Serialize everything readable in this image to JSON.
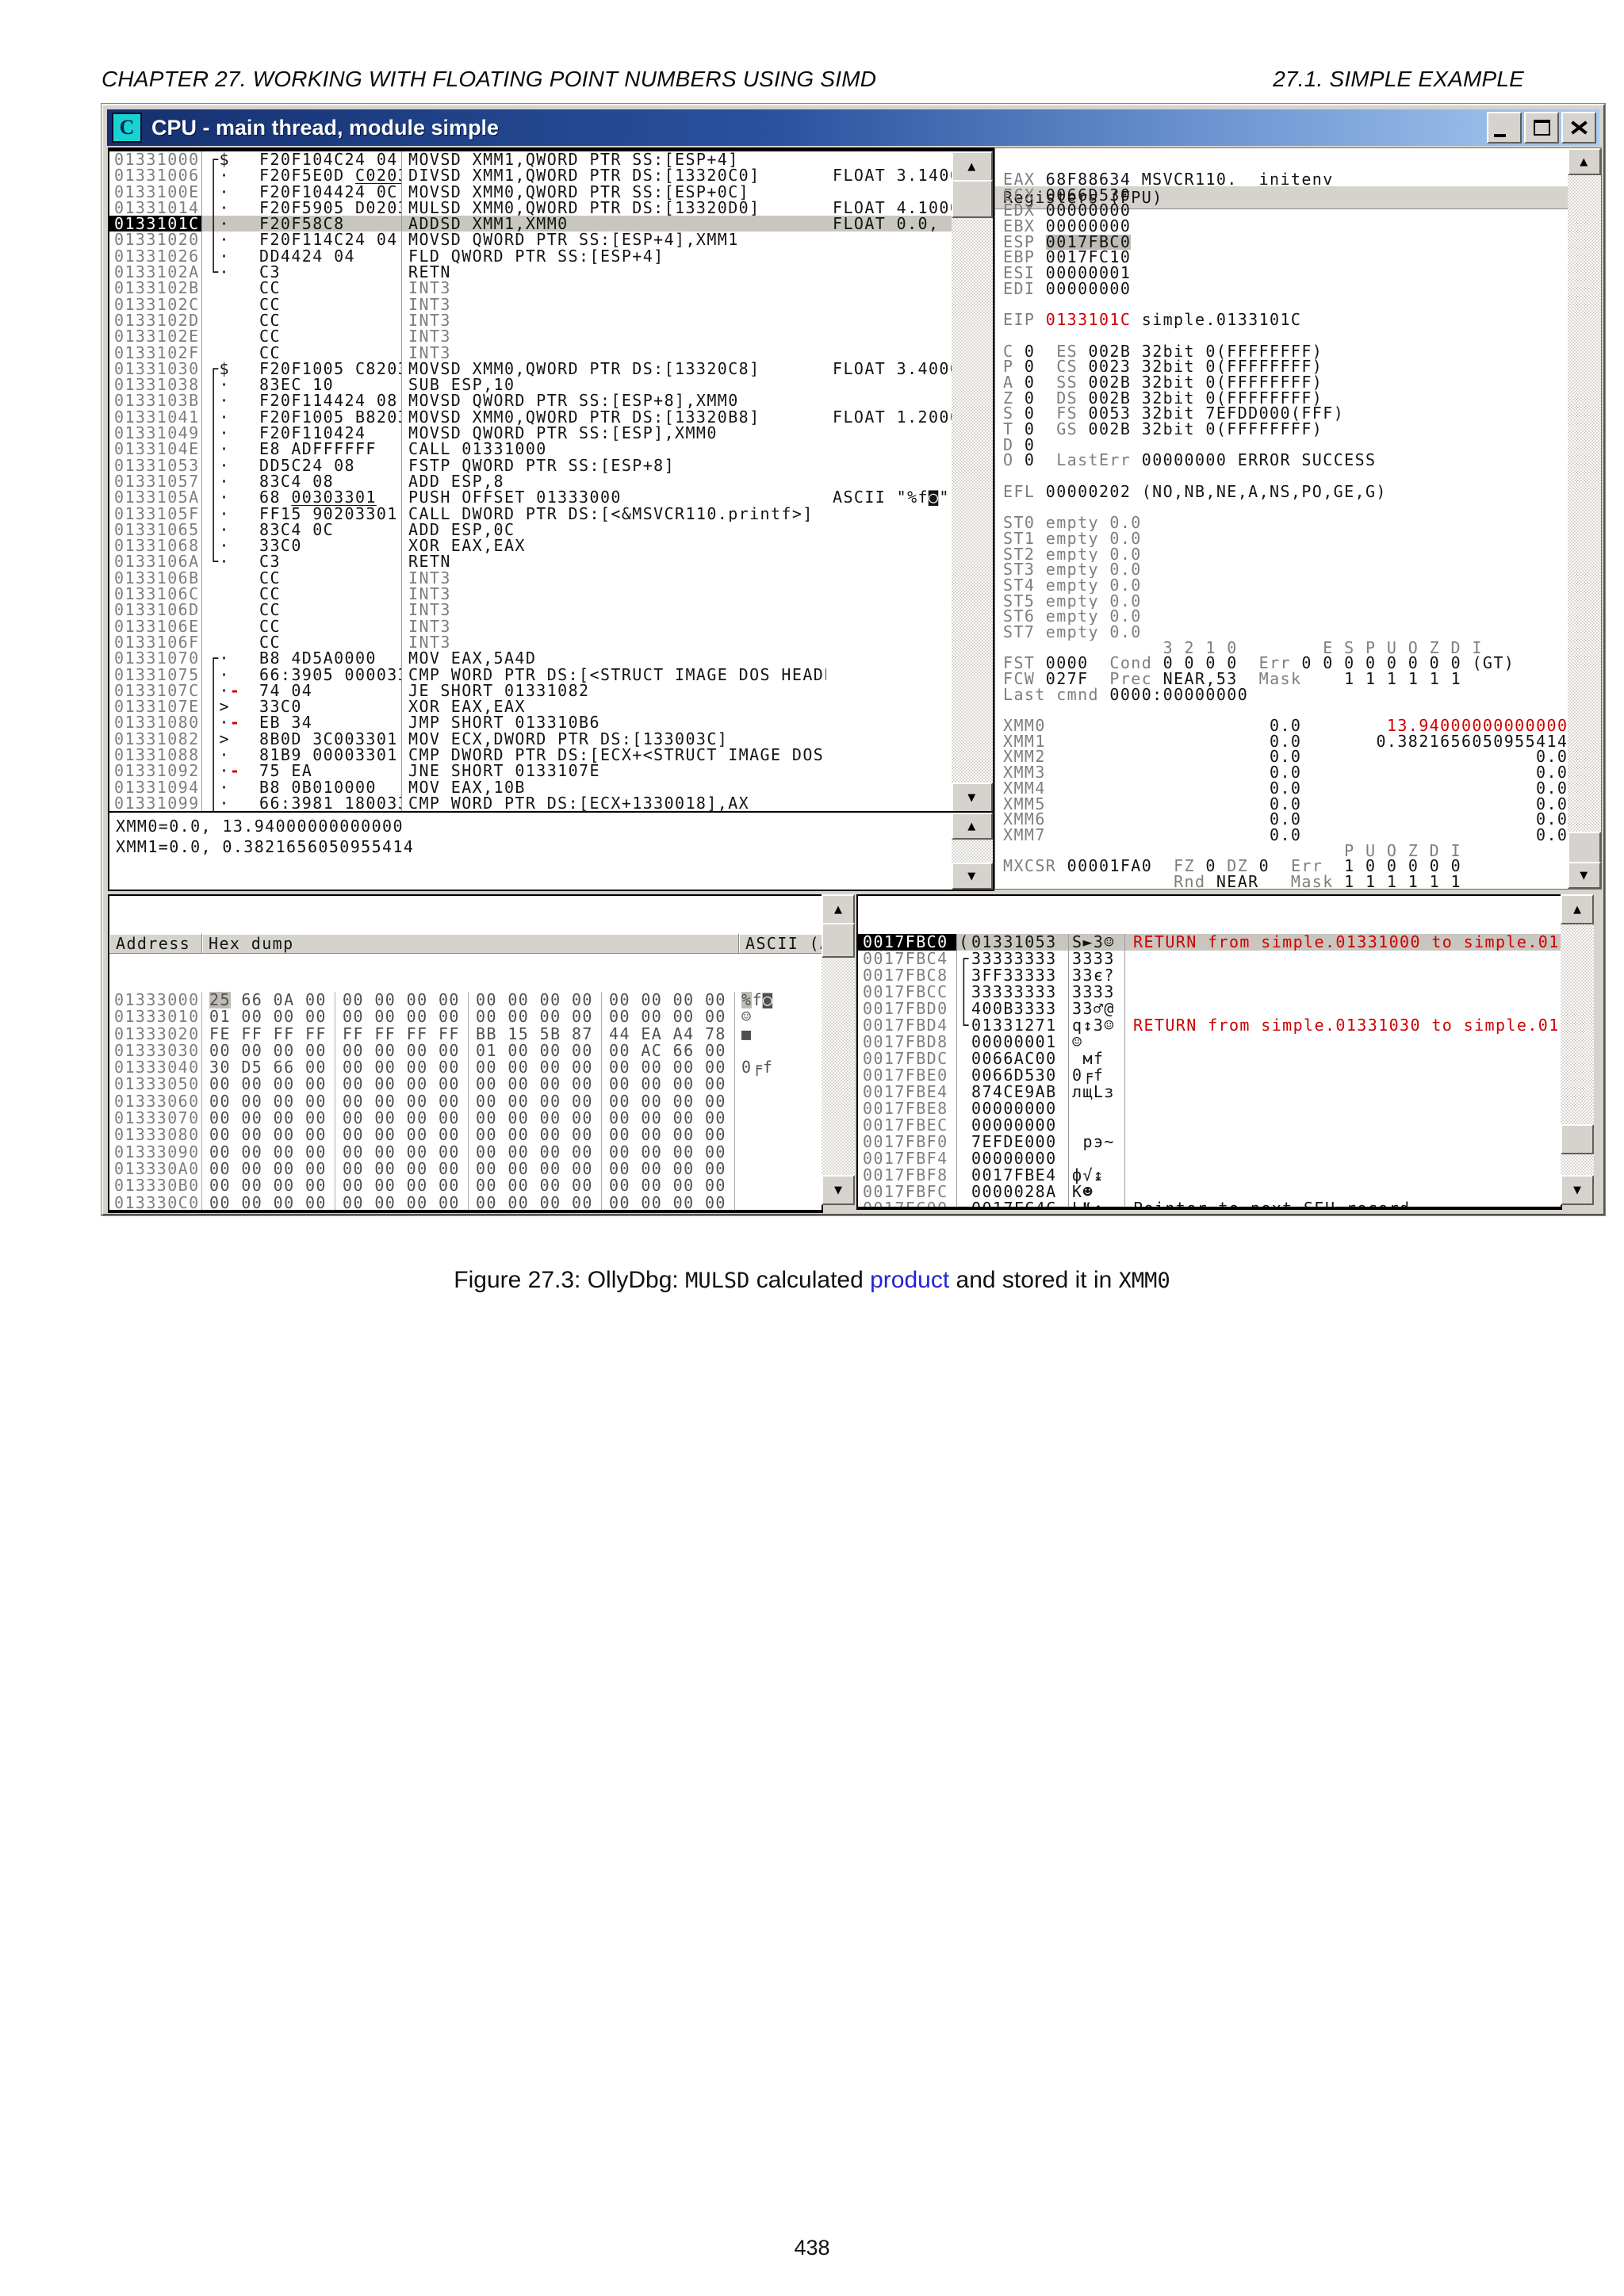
{
  "page": {
    "header_left": "CHAPTER 27.  WORKING WITH FLOATING POINT NUMBERS USING SIMD",
    "header_right": "27.1.  SIMPLE EXAMPLE",
    "page_number": "438",
    "caption": {
      "p1": "Figure 27.3: OllyDbg: ",
      "m1": "MULSD",
      "p2": " calculated ",
      "link": "product",
      "p3": " and stored it in ",
      "m2": "XMM0"
    }
  },
  "window": {
    "title": "CPU - main thread, module simple",
    "icon_letter": "C"
  },
  "colors": {
    "accent_red": "#CE0000",
    "link_blue": "#2323d8",
    "title_gradient_left": "#15306F",
    "title_gradient_right": "#A9CBF2",
    "selection_gray": "#C9C6BF"
  },
  "disasm": {
    "rows": [
      {
        "a": "01331000",
        "br": "┌",
        "m": "$",
        "b": "F20F104C24 04",
        "i": "MOVSD XMM1,QWORD PTR SS:[ESP+4]"
      },
      {
        "a": "01331006",
        "br": "│",
        "m": "·",
        "b": "F20F5E0D ",
        "u": "C0203301",
        "i": "DIVSD XMM1,QWORD PTR DS:[13320C0]",
        "c": "FLOAT 3.140000000000000"
      },
      {
        "a": "0133100E",
        "br": "│",
        "m": "·",
        "b": "F20F104424 0C",
        "i": "MOVSD XMM0,QWORD PTR SS:[ESP+0C]"
      },
      {
        "a": "01331014",
        "br": "│",
        "m": "·",
        "b": "F20F5905 ",
        "u": "D0203301",
        "i": "MULSD XMM0,QWORD PTR DS:[13320D0]",
        "c": "FLOAT 4.100000000000000"
      },
      {
        "a": "0133101C",
        "sel": true,
        "br": "│",
        "m": "·",
        "b": "F20F58C8",
        "i": "ADDSD XMM1,XMM0",
        "c": "FLOAT 0.0, 13.94000000000000"
      },
      {
        "a": "01331020",
        "br": "│",
        "m": "·",
        "b": "F20F114C24 04",
        "i": "MOVSD QWORD PTR SS:[ESP+4],XMM1"
      },
      {
        "a": "01331026",
        "br": "│",
        "m": "·",
        "b": "DD4424 04",
        "i": "FLD QWORD PTR SS:[ESP+4]"
      },
      {
        "a": "0133102A",
        "br": "└",
        "m": "·",
        "b": "C3",
        "i": "RETN"
      },
      {
        "a": "0133102B",
        "b": "CC",
        "i": "INT3",
        "gray": true
      },
      {
        "a": "0133102C",
        "b": "CC",
        "i": "INT3",
        "gray": true
      },
      {
        "a": "0133102D",
        "b": "CC",
        "i": "INT3",
        "gray": true
      },
      {
        "a": "0133102E",
        "b": "CC",
        "i": "INT3",
        "gray": true
      },
      {
        "a": "0133102F",
        "b": "CC",
        "i": "INT3",
        "gray": true
      },
      {
        "a": "01331030",
        "br": "┌",
        "m": "$",
        "b": "F20F1005 ",
        "u": "C8203301",
        "i": "MOVSD XMM0,QWORD PTR DS:[13320C8]",
        "c": "FLOAT 3.400000000000000"
      },
      {
        "a": "01331038",
        "br": "│",
        "m": "·",
        "b": "83EC 10",
        "i": "SUB ESP,10"
      },
      {
        "a": "0133103B",
        "br": "│",
        "m": "·",
        "b": "F20F114424 08",
        "i": "MOVSD QWORD PTR SS:[ESP+8],XMM0"
      },
      {
        "a": "01331041",
        "br": "│",
        "m": "·",
        "b": "F20F1005 ",
        "u": "B8203301",
        "i": "MOVSD XMM0,QWORD PTR DS:[13320B8]",
        "c": "FLOAT 1.200000000000000"
      },
      {
        "a": "01331049",
        "br": "│",
        "m": "·",
        "b": "F20F110424",
        "i": "MOVSD QWORD PTR SS:[ESP],XMM0"
      },
      {
        "a": "0133104E",
        "br": "│",
        "m": "·",
        "b": "E8 ADFFFFFF",
        "i": "CALL 01331000"
      },
      {
        "a": "01331053",
        "br": "│",
        "m": "·",
        "b": "DD5C24 08",
        "i": "FSTP QWORD PTR SS:[ESP+8]"
      },
      {
        "a": "01331057",
        "br": "│",
        "m": "·",
        "b": "83C4 08",
        "i": "ADD ESP,8"
      },
      {
        "a": "0133105A",
        "br": "│",
        "m": "·",
        "b": "68 ",
        "u": "00303301",
        "i": "PUSH OFFSET 01333000",
        "c": "ASCII \"%f◙\""
      },
      {
        "a": "0133105F",
        "br": "│",
        "m": "·",
        "b": "FF15 ",
        "u": "90203301",
        "i": "CALL DWORD PTR DS:[<&MSVCR110.printf>]"
      },
      {
        "a": "01331065",
        "br": "│",
        "m": "·",
        "b": "83C4 0C",
        "i": "ADD ESP,0C"
      },
      {
        "a": "01331068",
        "br": "│",
        "m": "·",
        "b": "33C0",
        "i": "XOR EAX,EAX"
      },
      {
        "a": "0133106A",
        "br": "└",
        "m": "·",
        "b": "C3",
        "i": "RETN"
      },
      {
        "a": "0133106B",
        "b": "CC",
        "i": "INT3",
        "gray": true
      },
      {
        "a": "0133106C",
        "b": "CC",
        "i": "INT3",
        "gray": true
      },
      {
        "a": "0133106D",
        "b": "CC",
        "i": "INT3",
        "gray": true
      },
      {
        "a": "0133106E",
        "b": "CC",
        "i": "INT3",
        "gray": true
      },
      {
        "a": "0133106F",
        "b": "CC",
        "i": "INT3",
        "gray": true
      },
      {
        "a": "01331070",
        "br": "┌",
        "m": "·",
        "b": "B8 4D5A0000",
        "i": "MOV EAX,5A4D"
      },
      {
        "a": "01331075",
        "br": "│",
        "m": "·",
        "b": "66:3905 ",
        "u": "00003301",
        "i": "CMP WORD PTR DS:[<STRUCT IMAGE_DOS_HEADER"
      },
      {
        "a": "0133107C",
        "br": "│",
        "m": "·",
        "dash": true,
        "b": "74 04",
        "i": "JE SHORT 01331082"
      },
      {
        "a": "0133107E",
        "br": "│",
        "m": ">",
        "b": "33C0",
        "i": "XOR EAX,EAX"
      },
      {
        "a": "01331080",
        "br": "│",
        "m": "·",
        "dash": true,
        "b": "EB 34",
        "i": "JMP SHORT 013310B6"
      },
      {
        "a": "01331082",
        "br": "│",
        "m": ">",
        "b": "8B0D ",
        "u": "3C003301",
        "i": "MOV ECX,DWORD PTR DS:[133003C]"
      },
      {
        "a": "01331088",
        "br": "│",
        "m": "·",
        "b": "81B9 ",
        "u": "00003301",
        "i": "CMP DWORD PTR DS:[ECX+<STRUCT IMAGE_DOS_H"
      },
      {
        "a": "01331092",
        "br": "│",
        "m": "·",
        "dash": true,
        "b": "75 EA",
        "i": "JNE SHORT 0133107E"
      },
      {
        "a": "01331094",
        "br": "│",
        "m": "·",
        "b": "B8 0B010000",
        "i": "MOV EAX,10B"
      },
      {
        "a": "01331099",
        "br": "│",
        "m": "·",
        "b": "66:3981 ",
        "u": "18003301",
        "i": "CMP WORD PTR DS:[ECX+1330018],AX"
      }
    ]
  },
  "info_pane": {
    "lines": [
      "XMM0=0.0, 13.94000000000000",
      "XMM1=0.0, 0.3821656050955414"
    ]
  },
  "registers": {
    "title": "Registers (FPU)",
    "lines": [
      [
        [
          "EAX ",
          "n"
        ],
        [
          "68F88634 MSVCR110.__initenv",
          ""
        ]
      ],
      [
        [
          "ECX ",
          "n"
        ],
        [
          "0066D530",
          ""
        ]
      ],
      [
        [
          "EDX ",
          "n"
        ],
        [
          "00000000",
          ""
        ]
      ],
      [
        [
          "EBX ",
          "n"
        ],
        [
          "00000000",
          ""
        ]
      ],
      [
        [
          "ESP ",
          "n"
        ],
        [
          "0017FBC0",
          "h"
        ]
      ],
      [
        [
          "EBP ",
          "n"
        ],
        [
          "0017FC10",
          ""
        ]
      ],
      [
        [
          "ESI ",
          "n"
        ],
        [
          "00000001",
          ""
        ]
      ],
      [
        [
          "EDI ",
          "n"
        ],
        [
          "00000000",
          ""
        ]
      ],
      [],
      [
        [
          "EIP ",
          "n"
        ],
        [
          "0133101C",
          "r"
        ],
        [
          " simple.0133101C",
          ""
        ]
      ],
      [],
      [
        [
          "C ",
          "n"
        ],
        [
          "0  ",
          ""
        ],
        [
          "ES ",
          "n"
        ],
        [
          "002B 32bit 0(FFFFFFFF)",
          ""
        ]
      ],
      [
        [
          "P ",
          "n"
        ],
        [
          "0  ",
          ""
        ],
        [
          "CS ",
          "n"
        ],
        [
          "0023 32bit 0(FFFFFFFF)",
          ""
        ]
      ],
      [
        [
          "A ",
          "n"
        ],
        [
          "0  ",
          ""
        ],
        [
          "SS ",
          "n"
        ],
        [
          "002B 32bit 0(FFFFFFFF)",
          ""
        ]
      ],
      [
        [
          "Z ",
          "n"
        ],
        [
          "0  ",
          ""
        ],
        [
          "DS ",
          "n"
        ],
        [
          "002B 32bit 0(FFFFFFFF)",
          ""
        ]
      ],
      [
        [
          "S ",
          "n"
        ],
        [
          "0  ",
          ""
        ],
        [
          "FS ",
          "n"
        ],
        [
          "0053 32bit 7EFDD000(FFF)",
          ""
        ]
      ],
      [
        [
          "T ",
          "n"
        ],
        [
          "0  ",
          ""
        ],
        [
          "GS ",
          "n"
        ],
        [
          "002B 32bit 0(FFFFFFFF)",
          ""
        ]
      ],
      [
        [
          "D ",
          "n"
        ],
        [
          "0",
          ""
        ]
      ],
      [
        [
          "O ",
          "n"
        ],
        [
          "0  ",
          ""
        ],
        [
          "LastErr ",
          "n"
        ],
        [
          "00000000 ERROR_SUCCESS",
          ""
        ]
      ],
      [],
      [
        [
          "EFL ",
          "n"
        ],
        [
          "00000202 (NO,NB,NE,A,NS,PO,GE,G)",
          ""
        ]
      ],
      [],
      [
        [
          "ST0 empty 0.0",
          "n"
        ]
      ],
      [
        [
          "ST1 empty 0.0",
          "n"
        ]
      ],
      [
        [
          "ST2 empty 0.0",
          "n"
        ]
      ],
      [
        [
          "ST3 empty 0.0",
          "n"
        ]
      ],
      [
        [
          "ST4 empty 0.0",
          "n"
        ]
      ],
      [
        [
          "ST5 empty 0.0",
          "n"
        ]
      ],
      [
        [
          "ST6 empty 0.0",
          "n"
        ]
      ],
      [
        [
          "ST7 empty 0.0",
          "n"
        ]
      ],
      [
        [
          "               3 2 1 0        E S P U O Z D I",
          "n"
        ]
      ],
      [
        [
          "FST ",
          "n"
        ],
        [
          "0000  ",
          ""
        ],
        [
          "Cond ",
          "n"
        ],
        [
          "0 0 0 0  ",
          ""
        ],
        [
          "Err ",
          "n"
        ],
        [
          "0 0 0 0 0 0 0 0 (GT)",
          ""
        ]
      ],
      [
        [
          "FCW ",
          "n"
        ],
        [
          "027F  ",
          ""
        ],
        [
          "Prec ",
          "n"
        ],
        [
          "NEAR,53  ",
          ""
        ],
        [
          "Mask ",
          "n"
        ],
        [
          "   1 1 1 1 1 1",
          ""
        ]
      ],
      [
        [
          "Last cmnd ",
          "n"
        ],
        [
          "0000:00000000",
          ""
        ]
      ],
      [],
      [
        [
          "XMM0",
          "n"
        ],
        [
          "                     0.0        ",
          ""
        ],
        [
          "13.94000000000000",
          "r"
        ]
      ],
      [
        [
          "XMM1",
          "n"
        ],
        [
          "                     0.0       ",
          ""
        ],
        [
          "0.3821656050955414",
          ""
        ]
      ],
      [
        [
          "XMM2",
          "n"
        ],
        [
          "                     0.0                      0.0",
          ""
        ]
      ],
      [
        [
          "XMM3",
          "n"
        ],
        [
          "                     0.0                      0.0",
          ""
        ]
      ],
      [
        [
          "XMM4",
          "n"
        ],
        [
          "                     0.0                      0.0",
          ""
        ]
      ],
      [
        [
          "XMM5",
          "n"
        ],
        [
          "                     0.0                      0.0",
          ""
        ]
      ],
      [
        [
          "XMM6",
          "n"
        ],
        [
          "                     0.0                      0.0",
          ""
        ]
      ],
      [
        [
          "XMM7",
          "n"
        ],
        [
          "                     0.0                      0.0",
          ""
        ]
      ],
      [
        [
          "                                P U O Z D I",
          "n"
        ]
      ],
      [
        [
          "MXCSR ",
          "n"
        ],
        [
          "00001FA0  ",
          ""
        ],
        [
          "FZ ",
          "n"
        ],
        [
          "0 ",
          ""
        ],
        [
          "DZ ",
          "n"
        ],
        [
          "0  ",
          ""
        ],
        [
          "Err  ",
          "n"
        ],
        [
          "1 0 0 0 0 0",
          ""
        ]
      ],
      [
        [
          "                ",
          "n"
        ],
        [
          "Rnd ",
          "n"
        ],
        [
          "NEAR   ",
          ""
        ],
        [
          "Mask ",
          "n"
        ],
        [
          "1 1 1 1 1 1",
          ""
        ]
      ]
    ]
  },
  "dump": {
    "headers": {
      "address": "Address",
      "hex": "Hex dump",
      "ascii": "ASCII (ANSI"
    },
    "rows": [
      {
        "a": "01333000",
        "g": [
          "25 66 0A 00",
          "00 00 00 00",
          "00 00 00 00",
          "00 00 00 00"
        ],
        "asc": "%f◙",
        "sel": true
      },
      {
        "a": "01333010",
        "g": [
          "01 00 00 00",
          "00 00 00 00",
          "00 00 00 00",
          "00 00 00 00"
        ],
        "asc": "☺"
      },
      {
        "a": "01333020",
        "g": [
          "FE FF FF FF",
          "FF FF FF FF",
          "BB 15 5B 87",
          "44 EA A4 78"
        ],
        "asc": "■       ╗§[зDъдx"
      },
      {
        "a": "01333030",
        "g": [
          "00 00 00 00",
          "00 00 00 00",
          "01 00 00 00",
          "00 AC 66 00"
        ],
        "asc": ""
      },
      {
        "a": "01333040",
        "g": [
          "30 D5 66 00",
          "00 00 00 00",
          "00 00 00 00",
          "00 00 00 00"
        ],
        "asc": "0╒f"
      },
      {
        "a": "01333050",
        "g": [
          "00 00 00 00",
          "00 00 00 00",
          "00 00 00 00",
          "00 00 00 00"
        ],
        "asc": ""
      },
      {
        "a": "01333060",
        "g": [
          "00 00 00 00",
          "00 00 00 00",
          "00 00 00 00",
          "00 00 00 00"
        ],
        "asc": ""
      },
      {
        "a": "01333070",
        "g": [
          "00 00 00 00",
          "00 00 00 00",
          "00 00 00 00",
          "00 00 00 00"
        ],
        "asc": ""
      },
      {
        "a": "01333080",
        "g": [
          "00 00 00 00",
          "00 00 00 00",
          "00 00 00 00",
          "00 00 00 00"
        ],
        "asc": ""
      },
      {
        "a": "01333090",
        "g": [
          "00 00 00 00",
          "00 00 00 00",
          "00 00 00 00",
          "00 00 00 00"
        ],
        "asc": ""
      },
      {
        "a": "013330A0",
        "g": [
          "00 00 00 00",
          "00 00 00 00",
          "00 00 00 00",
          "00 00 00 00"
        ],
        "asc": ""
      },
      {
        "a": "013330B0",
        "g": [
          "00 00 00 00",
          "00 00 00 00",
          "00 00 00 00",
          "00 00 00 00"
        ],
        "asc": ""
      },
      {
        "a": "013330C0",
        "g": [
          "00 00 00 00",
          "00 00 00 00",
          "00 00 00 00",
          "00 00 00 00"
        ],
        "asc": ""
      },
      {
        "a": "013330D0",
        "g": [
          "00 00 00 00",
          "00 00 00 00",
          "00 00 00 00",
          "00 00 00 00"
        ],
        "asc": ""
      },
      {
        "a": "013330E0",
        "g": [
          "00 00 00 00",
          "00 00 00 00",
          "00 00 00 00",
          "00 00 00 00"
        ],
        "asc": ""
      },
      {
        "a": "013330F0",
        "g": [
          "00 00 00 00",
          "00 00 00 00",
          "00 00 00 00",
          "00 00 00 00"
        ],
        "asc": ""
      },
      {
        "a": "01333100",
        "g": [
          "00 00 00 00",
          "00 00 00 00",
          "00 00 00 00",
          "00 00 00 00"
        ],
        "asc": ""
      },
      {
        "a": "01333110",
        "g": [
          "00 00 00 00",
          "00 00 00 00",
          "00 00 00 00",
          "00 00 00 00"
        ],
        "asc": ""
      }
    ]
  },
  "stack": {
    "rows": [
      {
        "a": "0017FBC0",
        "br": "(",
        "v": "01331053",
        "asc": "S►3☺",
        "c": "RETURN from simple.01331000 to simple.01331053",
        "red": true,
        "sel": true
      },
      {
        "a": "0017FBC4",
        "br": "┌",
        "v": "33333333",
        "asc": "3333"
      },
      {
        "a": "0017FBC8",
        "br": "│",
        "v": "3FF33333",
        "asc": "33є?"
      },
      {
        "a": "0017FBCC",
        "br": "│",
        "v": "33333333",
        "asc": "3333"
      },
      {
        "a": "0017FBD0",
        "br": "│",
        "v": "400B3333",
        "asc": "33♂@"
      },
      {
        "a": "0017FBD4",
        "br": "└",
        "v": "01331271",
        "asc": "q↕3☺",
        "c": "RETURN from simple.01331030 to simple.01331271",
        "red": true
      },
      {
        "a": "0017FBD8",
        "br": "",
        "v": "00000001",
        "asc": "☺"
      },
      {
        "a": "0017FBDC",
        "br": "",
        "v": "0066AC00",
        "asc": " мf"
      },
      {
        "a": "0017FBE0",
        "br": "",
        "v": "0066D530",
        "asc": "0╒f"
      },
      {
        "a": "0017FBE4",
        "br": "",
        "v": "874CE9AB",
        "asc": "лщLз"
      },
      {
        "a": "0017FBE8",
        "br": "",
        "v": "00000000",
        "asc": ""
      },
      {
        "a": "0017FBEC",
        "br": "",
        "v": "00000000",
        "asc": ""
      },
      {
        "a": "0017FBF0",
        "br": "",
        "v": "7EFDE000",
        "asc": " рэ~"
      },
      {
        "a": "0017FBF4",
        "br": "",
        "v": "00000000",
        "asc": ""
      },
      {
        "a": "0017FBF8",
        "br": "",
        "v": "0017FBE4",
        "asc": "ф√↨"
      },
      {
        "a": "0017FBFC",
        "br": "",
        "v": "0000028A",
        "asc": "К☻"
      },
      {
        "a": "0017FC00",
        "br": "",
        "v": "0017FC4C",
        "asc": "L№↨",
        "c": "Pointer to next SEH record"
      },
      {
        "a": "0017FC04",
        "br": "",
        "v": "013316F9",
        "asc": "∙▬3☺",
        "c": "SE handler"
      },
      {
        "a": "0017FC08",
        "br": "",
        "v": "866834F3",
        "asc": "є4hЖ"
      }
    ]
  }
}
